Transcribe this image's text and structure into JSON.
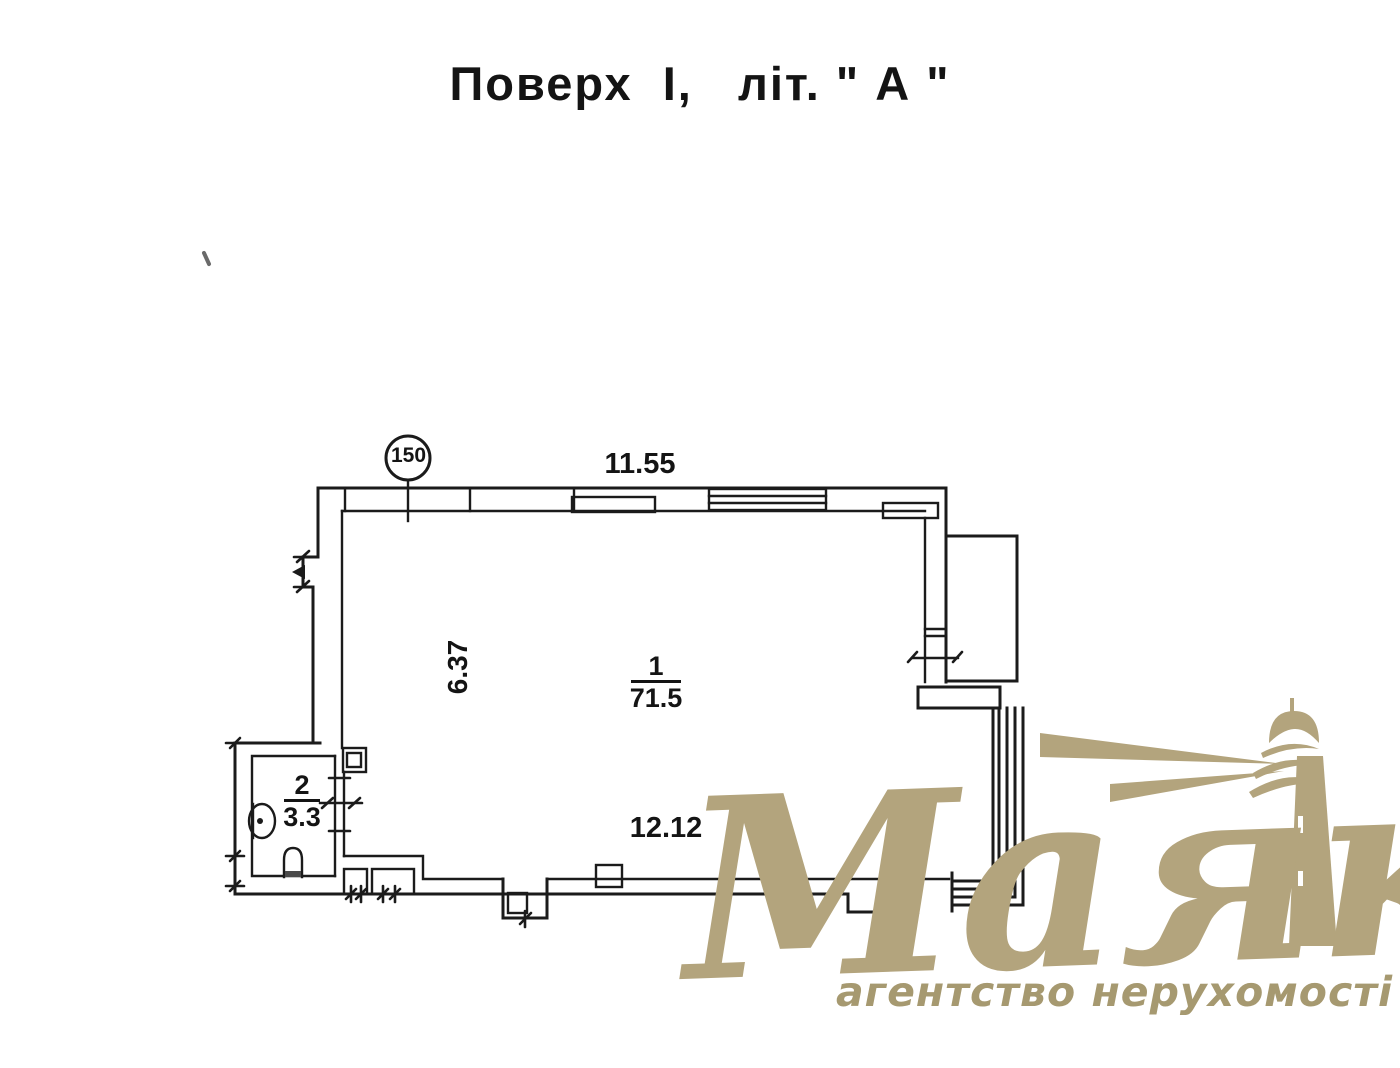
{
  "title": "Поверх  I,   літ. \" А \"",
  "floor_plan": {
    "leader_bubble": "150",
    "dimensions": {
      "top_width": "11.55",
      "left_height": "6.37",
      "bottom_width": "12.12"
    },
    "rooms": [
      {
        "number": "1",
        "area": "71.5"
      },
      {
        "number": "2",
        "area": "3.3"
      }
    ]
  },
  "watermark": {
    "brand": "Маяк",
    "tagline": "агентство нерухомості",
    "brand_color": "#b3a47d",
    "tagline_color": "#a69970"
  },
  "colors": {
    "wall_line": "#1b1b1b",
    "background": "#ffffff"
  }
}
